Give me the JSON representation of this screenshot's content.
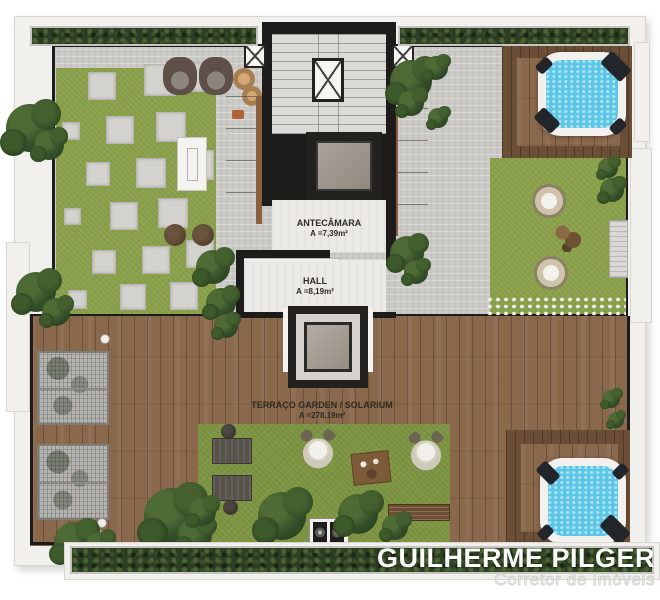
{
  "plan_title": "Rooftop terrace floor plan",
  "rooms": {
    "antecamara": {
      "name": "ANTECÂMARA",
      "area": "A =7,39m²"
    },
    "hall": {
      "name": "HALL",
      "area": "A =8,19m²"
    },
    "terraco": {
      "name": "TERRAÇO GARDEN / SOLARIUM",
      "area": "A =278,19m²"
    }
  },
  "watermark": {
    "name": "GUILHERME PILGER",
    "subtitle": "Corretor de Imóveis"
  },
  "colors": {
    "wall": "#1d1c1a",
    "concrete": "#cbcac6",
    "interior_floor": "#eceae6",
    "stair_floor": "#dbdad6",
    "grass": "#8ba24c",
    "lawn": "#7e9643",
    "hedge": "#2c3d24",
    "wood": "#8a684b",
    "wood_dark": "#6b4e36",
    "tub_water": "#5cc6e6",
    "tub_rim": "#f2f1ed",
    "frame": "#f1f0ed",
    "frame_line": "#d8d6d2",
    "label_text": "#2e2a24",
    "watermark_white": "#fbfbfa"
  },
  "scene": {
    "stepping_stones": [
      {
        "x": 88,
        "y": 72,
        "s": 26
      },
      {
        "x": 144,
        "y": 64,
        "s": 30
      },
      {
        "x": 184,
        "y": 62,
        "s": 28
      },
      {
        "x": 62,
        "y": 122,
        "s": 16
      },
      {
        "x": 106,
        "y": 116,
        "s": 26
      },
      {
        "x": 156,
        "y": 112,
        "s": 28
      },
      {
        "x": 86,
        "y": 162,
        "s": 22
      },
      {
        "x": 136,
        "y": 158,
        "s": 28
      },
      {
        "x": 184,
        "y": 150,
        "s": 28
      },
      {
        "x": 64,
        "y": 208,
        "s": 15
      },
      {
        "x": 110,
        "y": 202,
        "s": 26
      },
      {
        "x": 158,
        "y": 198,
        "s": 28
      },
      {
        "x": 92,
        "y": 250,
        "s": 22
      },
      {
        "x": 142,
        "y": 246,
        "s": 26
      },
      {
        "x": 186,
        "y": 240,
        "s": 26
      },
      {
        "x": 68,
        "y": 290,
        "s": 17
      },
      {
        "x": 120,
        "y": 284,
        "s": 24
      },
      {
        "x": 170,
        "y": 282,
        "s": 26
      }
    ],
    "bushes": [
      {
        "x": 6,
        "y": 104,
        "s": 48
      },
      {
        "x": 34,
        "y": 130,
        "s": 30
      },
      {
        "x": 16,
        "y": 272,
        "s": 40
      },
      {
        "x": 42,
        "y": 298,
        "s": 28
      },
      {
        "x": 196,
        "y": 250,
        "s": 34
      },
      {
        "x": 206,
        "y": 288,
        "s": 30
      },
      {
        "x": 214,
        "y": 314,
        "s": 24
      },
      {
        "x": 390,
        "y": 60,
        "s": 42
      },
      {
        "x": 424,
        "y": 56,
        "s": 24
      },
      {
        "x": 398,
        "y": 90,
        "s": 26
      },
      {
        "x": 428,
        "y": 108,
        "s": 20
      },
      {
        "x": 390,
        "y": 236,
        "s": 34
      },
      {
        "x": 404,
        "y": 260,
        "s": 24
      },
      {
        "x": 598,
        "y": 158,
        "s": 20
      },
      {
        "x": 600,
        "y": 178,
        "s": 24
      },
      {
        "x": 602,
        "y": 390,
        "s": 18
      },
      {
        "x": 608,
        "y": 412,
        "s": 16
      },
      {
        "x": 144,
        "y": 488,
        "s": 56
      },
      {
        "x": 178,
        "y": 518,
        "s": 34
      },
      {
        "x": 54,
        "y": 522,
        "s": 40
      },
      {
        "x": 86,
        "y": 532,
        "s": 26
      },
      {
        "x": 258,
        "y": 492,
        "s": 48
      },
      {
        "x": 338,
        "y": 494,
        "s": 40
      },
      {
        "x": 382,
        "y": 514,
        "s": 26
      },
      {
        "x": 188,
        "y": 498,
        "s": 28
      }
    ]
  }
}
